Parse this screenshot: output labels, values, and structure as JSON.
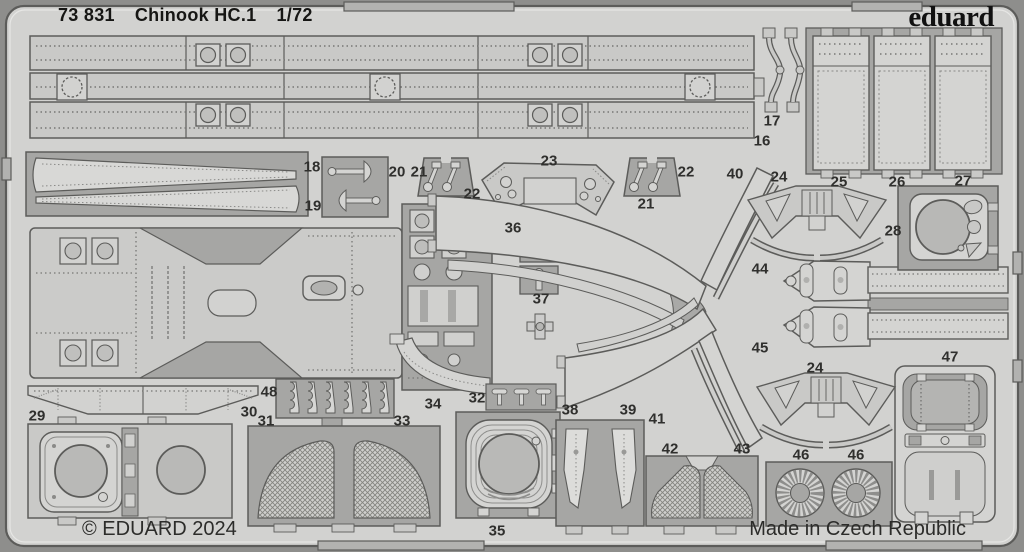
{
  "header": {
    "catalog_number": "73 831",
    "product_name": "Chinook HC.1",
    "scale": "1/72"
  },
  "brand": {
    "logo_text": "eduard"
  },
  "footer": {
    "copyright": "© EDUARD 2024",
    "made_in": "Made in Czech Republic"
  },
  "sheet": {
    "description": "photo-etched brass fret with numbered parts 16-48",
    "colors": {
      "photo_background": "#8e8e8c",
      "sheet": "#d2d2d0",
      "metal_part": "#c9c9c7",
      "recessed_block": "#a6a6a4",
      "outline": "#5c5c5a",
      "label_text": "#2f2f2d"
    }
  },
  "part_labels": [
    {
      "label": "16",
      "x": 762,
      "y": 141
    },
    {
      "label": "17",
      "x": 772,
      "y": 121
    },
    {
      "label": "18",
      "x": 312,
      "y": 167
    },
    {
      "label": "19",
      "x": 313,
      "y": 206
    },
    {
      "label": "20",
      "x": 397,
      "y": 172
    },
    {
      "label": "21",
      "x": 419,
      "y": 172
    },
    {
      "label": "22",
      "x": 472,
      "y": 194
    },
    {
      "label": "23",
      "x": 549,
      "y": 161
    },
    {
      "label": "22",
      "x": 686,
      "y": 172
    },
    {
      "label": "21",
      "x": 646,
      "y": 204
    },
    {
      "label": "40",
      "x": 735,
      "y": 174
    },
    {
      "label": "24",
      "x": 779,
      "y": 177
    },
    {
      "label": "25",
      "x": 839,
      "y": 182
    },
    {
      "label": "26",
      "x": 897,
      "y": 182
    },
    {
      "label": "27",
      "x": 963,
      "y": 181
    },
    {
      "label": "28",
      "x": 893,
      "y": 231
    },
    {
      "label": "36",
      "x": 513,
      "y": 228
    },
    {
      "label": "37",
      "x": 541,
      "y": 299
    },
    {
      "label": "44",
      "x": 760,
      "y": 269
    },
    {
      "label": "45",
      "x": 760,
      "y": 348
    },
    {
      "label": "47",
      "x": 950,
      "y": 357
    },
    {
      "label": "29",
      "x": 37,
      "y": 416
    },
    {
      "label": "30",
      "x": 249,
      "y": 412
    },
    {
      "label": "48",
      "x": 269,
      "y": 392
    },
    {
      "label": "31",
      "x": 266,
      "y": 421
    },
    {
      "label": "33",
      "x": 402,
      "y": 421
    },
    {
      "label": "34",
      "x": 433,
      "y": 404
    },
    {
      "label": "32",
      "x": 477,
      "y": 398
    },
    {
      "label": "35",
      "x": 497,
      "y": 531
    },
    {
      "label": "38",
      "x": 570,
      "y": 410
    },
    {
      "label": "39",
      "x": 628,
      "y": 410
    },
    {
      "label": "41",
      "x": 657,
      "y": 419
    },
    {
      "label": "42",
      "x": 670,
      "y": 449
    },
    {
      "label": "43",
      "x": 742,
      "y": 449
    },
    {
      "label": "24",
      "x": 815,
      "y": 368
    },
    {
      "label": "46",
      "x": 801,
      "y": 455
    },
    {
      "label": "46",
      "x": 856,
      "y": 455
    }
  ]
}
